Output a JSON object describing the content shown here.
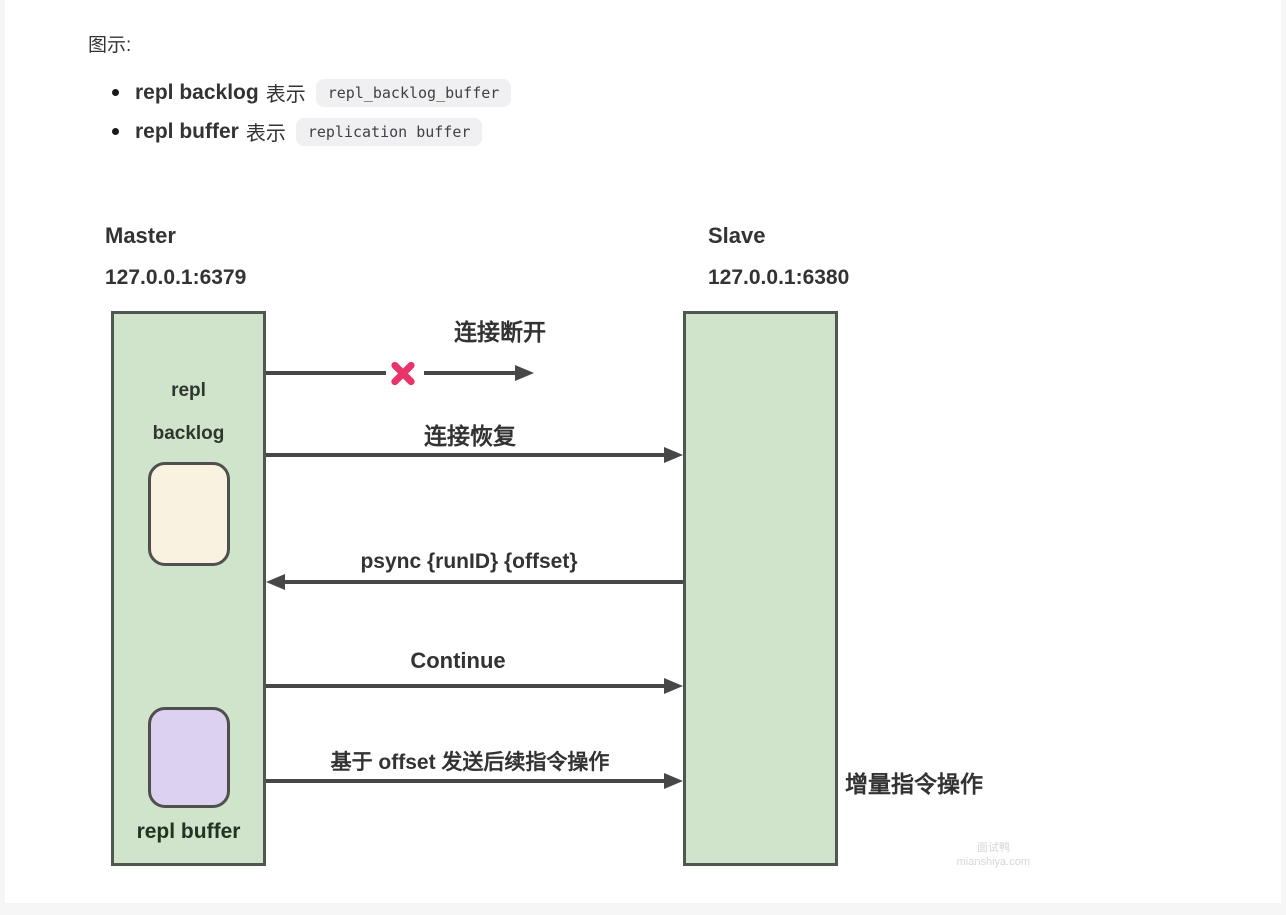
{
  "caption": "图示:",
  "legend": [
    {
      "term": "repl backlog",
      "middle": "表示",
      "code": "repl_backlog_buffer"
    },
    {
      "term": "repl buffer",
      "middle": "表示",
      "code": "replication buffer"
    }
  ],
  "diagram": {
    "master": {
      "title": "Master",
      "address": "127.0.0.1:6379",
      "backlog_label_line1": "repl",
      "backlog_label_line2": "backlog",
      "buffer_label": "repl buffer"
    },
    "slave": {
      "title": "Slave",
      "address": "127.0.0.1:6380"
    },
    "messages": [
      {
        "label": "连接断开",
        "direction": "master-to-slave",
        "broken": true
      },
      {
        "label": "连接恢复",
        "direction": "master-to-slave",
        "broken": false
      },
      {
        "label": "psync {runID} {offset}",
        "direction": "slave-to-master",
        "broken": false
      },
      {
        "label": "Continue",
        "direction": "master-to-slave",
        "broken": false
      },
      {
        "label": "基于 offset 发送后续指令操作",
        "direction": "master-to-slave",
        "broken": false
      }
    ],
    "side_note": "增量指令操作"
  },
  "watermark": {
    "line1": "面试鸭",
    "line2": "mianshiya.com"
  },
  "colors": {
    "node_fill": "#cfe4cb",
    "node_border": "#4e584e",
    "arrow": "#474747",
    "x_mark": "#e8336b",
    "backlog_fill": "#faf2e0",
    "buffer_fill": "#dcd2f0",
    "code_bg": "#f0f0f2",
    "text": "#333333"
  }
}
